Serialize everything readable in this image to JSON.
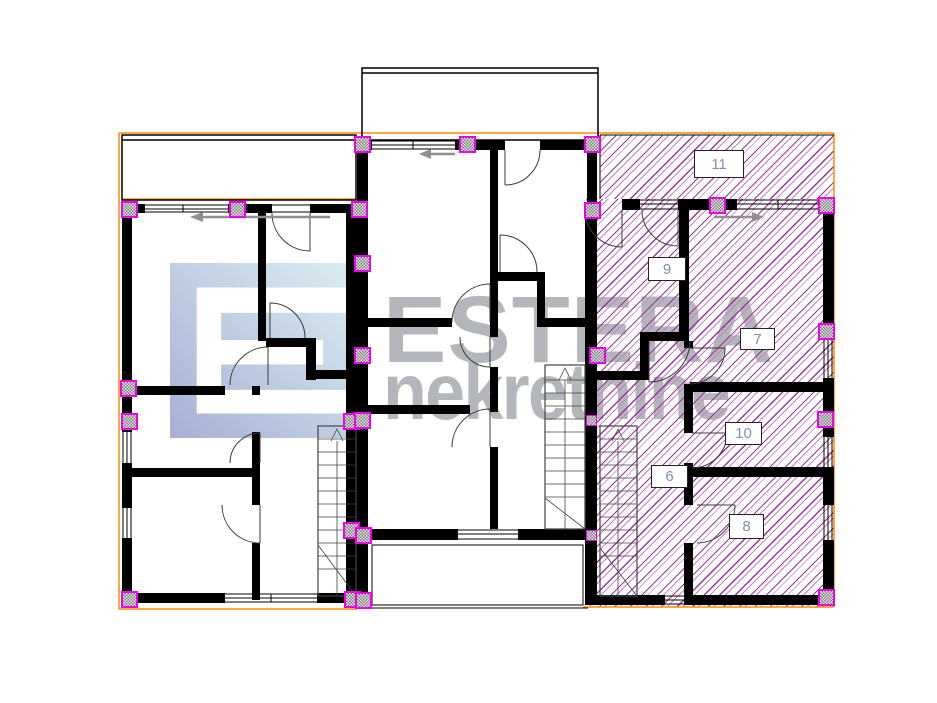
{
  "watermark": {
    "brand": "ESTERA",
    "subtitle": "nekretnine"
  },
  "rooms": [
    {
      "number": "11"
    },
    {
      "number": "9"
    },
    {
      "number": "7"
    },
    {
      "number": "10"
    },
    {
      "number": "6"
    },
    {
      "number": "8"
    }
  ],
  "colors": {
    "hatch_dark": "#9a359a",
    "hatch_light": "#c684c6",
    "pillar_border": "#ee00ee",
    "outline_orange": "#ff8c00",
    "watermark_gray": "#b3b6ba",
    "room_label_ink": "#8090a8",
    "logo_gradient_from": "#d9edf0",
    "logo_gradient_to": "#a7b0d6",
    "wall_black": "#000000"
  }
}
